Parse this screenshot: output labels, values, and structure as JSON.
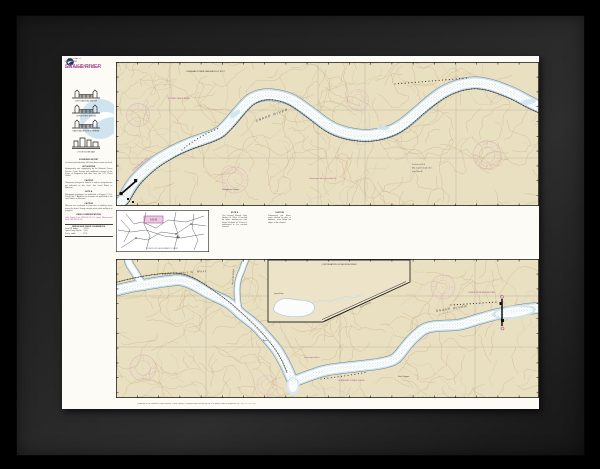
{
  "chart": {
    "agency": "NATIONAL OCEAN SERVICE",
    "state": "WASHINGTON",
    "title": "SNAKE RIVER",
    "subtitle": "LAKE HERBERT G. WEST",
    "scale_note": "SCALE 1:40,000",
    "production_note": "Produced at the National Ocean Service, Coast Survey - Compiled from surveys by the U.S. Army Corps of Engineers  14 - 18 - 21 - 5.2 - 9 ft",
    "sidebar": {
      "diagram_captions": [
        "JOSO RAILROAD BRIDGE",
        "LYONS FERRY BRIDGE",
        "RAILROAD BRIDGE AT RIPARIA",
        "LITTLE GOOSE DAM"
      ],
      "notes": [
        {
          "heading": "SOUNDINGS IN FEET",
          "body": "at normal pool elevation 540 feet above mean sea level"
        },
        {
          "heading": "AUTHORITIES",
          "body": "Hydrography and topography by the National Ocean Service, Coast Survey, with additional surveys by the Corps of Engineers and data from the U.S. Coast Guard."
        },
        {
          "heading": "CAUTION",
          "body": "Temporary changes or defects in aids to navigation are not indicated on this chart. See Local Notice to Mariners."
        },
        {
          "heading": "NOTE A",
          "body": "Navigation regulations are published in Chapter 2, U.S. Coast Pilot 7. Additions or revisions are published in the Local Notice to Mariners."
        },
        {
          "heading": "CAUTION",
          "body": "Mariners are cautioned to stay clear of spillway areas below the dams. Strong currents exist when spilling is in progress."
        },
        {
          "heading": "RADIO COMMUNICATIONS",
          "body": "Little Goose Lock VHF-FM Ch 14. Lower Monumental Lock VHF-FM Ch 14."
        }
      ],
      "table": {
        "heading": "BRIDGE AND CABLE CLEARANCES",
        "rows": [
          "Joso RR bridge . . . . . 170 ft",
          "Lyons Ferry hwy br . . 52 ft",
          "Power cable . . . . . . . 87 ft"
        ]
      }
    },
    "index_map": {
      "coverage_label": "18548",
      "note": "LOCATION OF LAKE HERBERT G. WEST"
    },
    "mid_notes": [
      {
        "heading": "NOTE B",
        "body": "The channel through Lake Herbert G. West is marked by lights, daybeacons and buoys. A depth of 14 feet is maintained in the marked channel."
      },
      {
        "heading": "CAUTION",
        "body": "Submerged pile dikes, some marked by piles or dolphins, exist along the edges of the channel."
      }
    ],
    "panel_top": {
      "river_label": "SNAKE RIVER",
      "labels": {
        "cable_note": "OVERHEAD POWER CABLE AUTH CL 87 FT",
        "dam": "LITTLE GOOSE DAM",
        "canyon": "Penawawa Canyon",
        "dike": "Submerged dikes (see Note B)",
        "cable_area": "POWER CABLE AREA",
        "table_lines": [
          "Pool elev 540 ft",
          "Min channel depth 14 ft",
          "(see Note A)"
        ]
      }
    },
    "panel_bottom": {
      "river_label": "SNAKE RIVER",
      "lake_label": "Lake Herbert G. West",
      "labels": {
        "palouse": "PALOUSE RIVER",
        "dam": "LOWER MONUMENTAL DAM",
        "inset_title": "CONTINUATION OF PALOUSE RIVER",
        "ferry": "Lyons Ferry",
        "joso": "JOSO BRIDGE",
        "canyon": "Burr Canyon",
        "dikes": "Submerged dikes",
        "cable": "OVERHEAD POWER CABLE",
        "ayer": "Ayer"
      }
    },
    "colors": {
      "land": "#e9dfc1",
      "water": "#fbfdfd",
      "shallow": "#cfe3ee",
      "magenta": "#b5519c",
      "rose_pink": "#d9a8c6",
      "contour": "#c3a87a"
    }
  }
}
